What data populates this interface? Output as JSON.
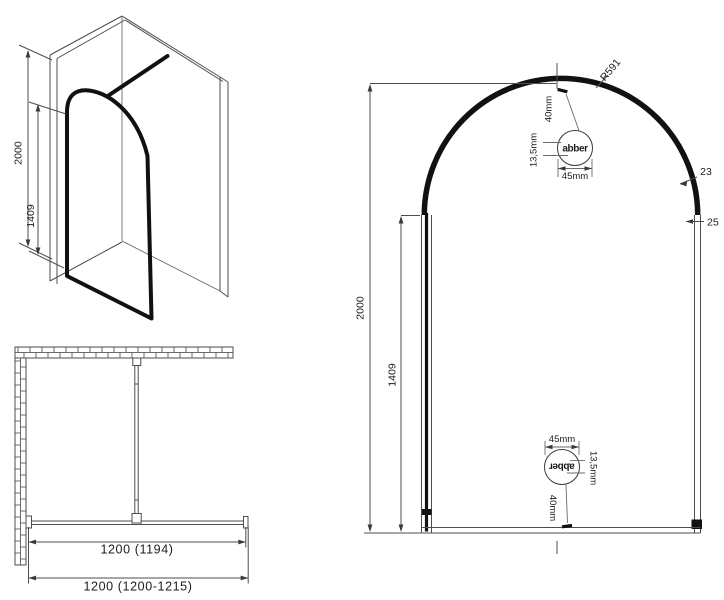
{
  "views": {
    "perspective": {
      "overall_height": "2000",
      "glass_height": "1409"
    },
    "plan": {
      "inner_width": "1200 (1194)",
      "outer_width": "1200 (1200-1215)"
    },
    "elevation": {
      "overall_height": "2000",
      "glass_height": "1409",
      "arch_radius": "R591",
      "frame_thickness": "23",
      "profile_width": "25",
      "logo_width": "45mm",
      "logo_text_height": "13,5mm",
      "logo_offset": "40mm",
      "brand": "abber"
    }
  },
  "colors": {
    "line": "#4d4d4d",
    "frame": "#111111",
    "text": "#1c1c1c",
    "background": "#ffffff"
  }
}
